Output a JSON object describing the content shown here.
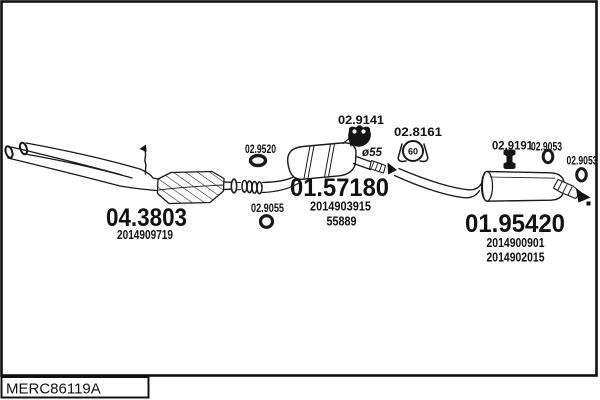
{
  "diagram": {
    "drawing_code": "MERC86119A",
    "colors": {
      "line": "#1a1a1a",
      "background": "#ffffff"
    },
    "labels": {
      "catalyst": {
        "code": "04.3803",
        "oe": "2014909719"
      },
      "centre_muffler": {
        "code": "01.57180",
        "oe": "2014903915",
        "oe2": "55889"
      },
      "rear_muffler": {
        "code": "01.95420",
        "oe": "2014900901",
        "oe2": "2014902015"
      },
      "gasket_front": {
        "code": "02.9520"
      },
      "ring_front": {
        "code": "02.9055"
      },
      "hanger_centre": {
        "code": "02.9141"
      },
      "clamp_centre": {
        "code": "02.8161",
        "diameter": "60"
      },
      "hanger_rear": {
        "code": "02.9191"
      },
      "ring_rear_inner": {
        "code": "02.9053"
      },
      "ring_rear_outer": {
        "code": "02.9053"
      },
      "pipe_diameter_note": "ø55"
    }
  }
}
